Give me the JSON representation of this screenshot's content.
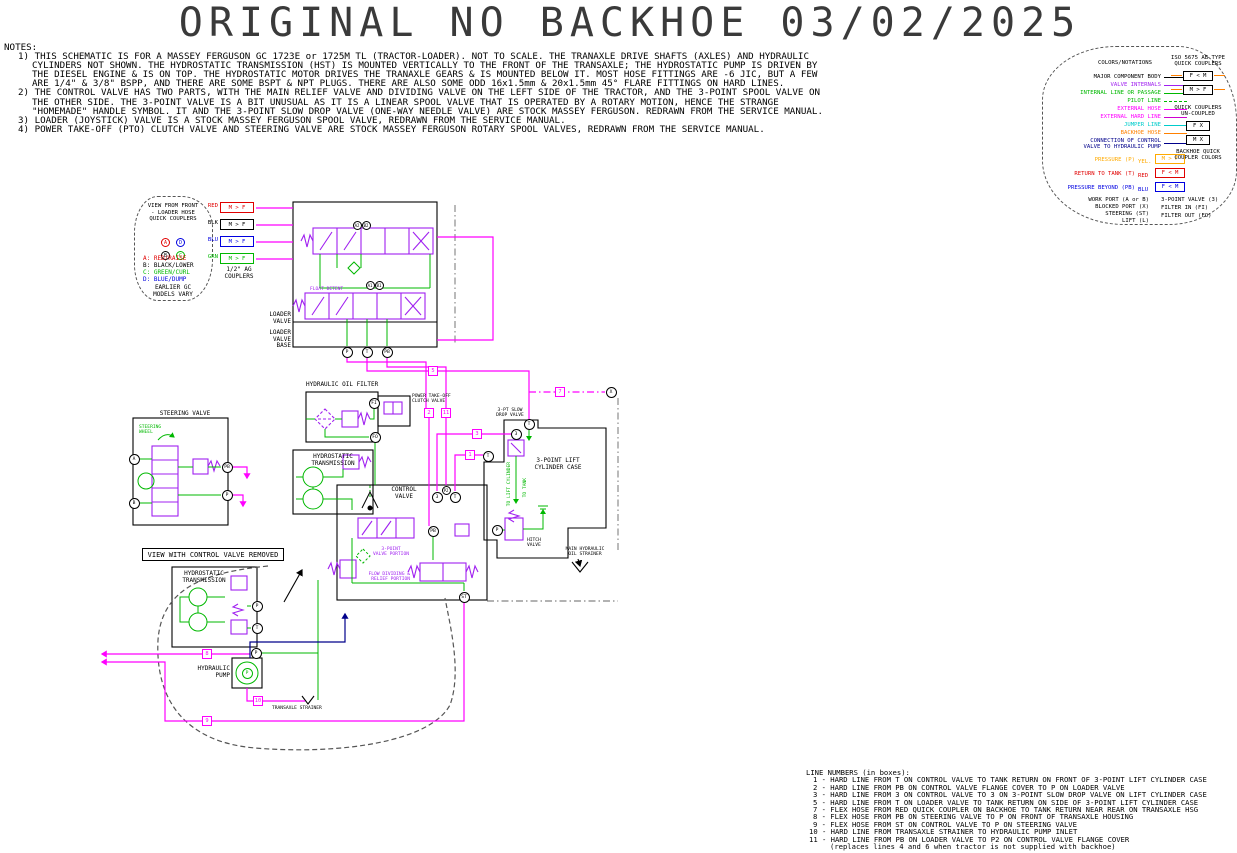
{
  "title": "ORIGINAL NO BACKHOE 03/02/2025",
  "notes": {
    "heading": "NOTES:",
    "items": [
      "1) THIS SCHEMATIC IS FOR A MASSEY FERGUSON GC 1723E or 1725M TL (TRACTOR-LOADER). NOT TO SCALE. THE TRANAXLE DRIVE SHAFTS (AXLES) AND HYDRAULIC\nCYLINDERS NOT SHOWN. THE HYDROSTATIC TRANSMISSION (HST) IS MOUNTED VERTICALLY TO THE FRONT OF THE TRANSAXLE; THE HYDROSTATIC PUMP IS DRIVEN BY\nTHE DIESEL ENGINE & IS ON TOP. THE HYDROSTATIC MOTOR DRIVES THE TRANAXLE GEARS & IS MOUNTED BELOW IT. MOST HOSE FITTINGS ARE -6 JIC, BUT A FEW\nARE 1/4\" & 3/8\" BSPP, AND THERE ARE SOME BSPT & NPT PLUGS. THERE ARE ALSO SOME ODD 16x1.5mm & 20x1.5mm 45° FLARE FITTINGS ON HARD LINES.",
      "2) THE CONTROL VALVE HAS TWO PARTS, WITH THE MAIN RELIEF VALVE AND DIVIDING VALVE ON THE LEFT SIDE OF THE TRACTOR, AND THE 3-POINT SPOOL VALVE ON\nTHE OTHER SIDE. THE 3-POINT VALVE IS A BIT UNUSUAL AS IT IS A LINEAR SPOOL VALVE THAT IS OPERATED BY A ROTARY MOTION, HENCE THE STRANGE\n\"HOMEMADE\" HANDLE SYMBOL. IT AND THE 3-POINT SLOW DROP VALVE (ONE-WAY NEEDLE VALVE) ARE STOCK MASSEY FERGUSON. REDRAWN FROM THE SERVICE MANUAL.",
      "3) LOADER (JOYSTICK) VALVE IS A STOCK MASSEY FERGUSON SPOOL VALVE, REDRAWN FROM THE SERVICE MANUAL.",
      "4) POWER TAKE-OFF (PTO) CLUTCH VALVE AND STEERING VALVE ARE STOCK MASSEY FERGUSON ROTARY SPOOL VALVES, REDRAWN FROM THE SERVICE MANUAL."
    ]
  },
  "legend": {
    "header": "COLORS/NOTATIONS",
    "rows": [
      {
        "label": "MAJOR COMPONENT BODY"
      },
      {
        "label": "VALVE INTERNALS"
      },
      {
        "label": "INTERNAL LINE OR PASSAGE"
      },
      {
        "label": "PILOT LINE"
      },
      {
        "label": "EXTERNAL HOSE"
      },
      {
        "label": "EXTERNAL HARD LINE"
      },
      {
        "label": "JUMPER LINE"
      },
      {
        "label": "BACKHOE HOSE"
      },
      {
        "label": "CONNECTION OF CONTROL\nVALVE TO HYDRAULIC PUMP"
      }
    ],
    "port_rows": [
      {
        "label": "PRESSURE (P)",
        "tag": "YEL.",
        "box": "M > F"
      },
      {
        "label": "RETURN TO TANK (T)",
        "tag": "RED",
        "box": "F < M"
      },
      {
        "label": "PRESSURE BEYOND (PB)",
        "tag": "BLU",
        "box": "F < M"
      }
    ],
    "abbrev": [
      "WORK PORT (A or B)",
      "BLOCKED PORT (X)",
      "STEERING (ST)",
      "LIFT (L)"
    ],
    "right": {
      "iso_header": "ISO 5675 AB TYPE\nQUICK COUPLERS",
      "iso_box1": "F < M",
      "iso_box2": "M > F",
      "unc_header": "QUICK COUPLERS\nUN-COUPLED",
      "unc_box1": "F X",
      "unc_box2": "M X",
      "backhoe_header": "BACKHOE QUICK\nCOUPLER COLORS",
      "abbrev2": [
        "3-POINT VALVE (3)",
        "FILTER IN (FI)",
        "FILTER OUT (FO)"
      ]
    },
    "colors": {
      "component": "#000000",
      "valve_internals": "#a020f0",
      "internal_line": "#00b800",
      "pilot_line": "#00b800",
      "external_hose": "#ff00ff",
      "external_hard_line": "#d000d0",
      "jumper_line": "#00cccc",
      "backhoe_hose": "#ff8000",
      "pump_connection": "#00008b",
      "pressure": "#ffaa00",
      "return_to_tank": "#e00000",
      "pressure_beyond": "#0000e0"
    }
  },
  "coupler_view": {
    "title": "VIEW FROM FRONT\n- LOADER HOSE\nQUICK COUPLERS",
    "c1": "A",
    "c2": "D",
    "c3": "B",
    "c4": "C",
    "list": [
      "A: RED/RAISE",
      "B: BLACK/LOWER",
      "C: GREEN/CURL",
      "D: BLUE/DUMP"
    ],
    "footer": "EARLIER GC\nMODELS VARY"
  },
  "couplers": {
    "tags": [
      "RED",
      "BLK",
      "BLU",
      "GRN"
    ],
    "box": "M > F",
    "caption": "1/2\" AG\nCOUPLERS"
  },
  "schematic": {
    "labels": {
      "loader_valve": "LOADER\nVALVE",
      "loader_valve_base": "LOADER\nVALVE\nBASE",
      "float_detent": "FLOAT DETENT",
      "hydraulic_oil_filter": "HYDRAULIC OIL FILTER",
      "pto_valve": "POWER TAKE-OFF\nCLUTCH VALVE",
      "hst": "HYDROSTATIC\nTRANSMISSION",
      "control_valve": "CONTROL\nVALVE",
      "three_point_portion": "3-POINT\nVALVE PORTION",
      "flow_div_portion": "FLOW DIVIDING &\nRELIEF PORTION",
      "steering_valve": "STEERING VALVE",
      "steering_wheel": "STEERING\nWHEEL",
      "cyl_case": "3-POINT LIFT\nCYLINDER CASE",
      "slow_drop": "3-PT SLOW\nDROP VALVE",
      "hitch_valve": "HITCH\nVALVE",
      "to_lift_cyl": "TO LIFT CYLINDER",
      "to_tank": "TO TANK",
      "main_strainer": "MAIN HYDRAULIC\nOIL STRAINER",
      "view_removed": "VIEW WITH CONTROL VALVE REMOVED",
      "hst2": "HYDROSTATIC\nTRANSMISSION",
      "hyd_pump": "HYDRAULIC\nPUMP",
      "transaxle_strainer": "TRANSAXLE STRAINER"
    },
    "ports": {
      "p": "P",
      "t": "T",
      "pb": "PB",
      "p2": "P2",
      "fi": "FI",
      "fo": "FO",
      "a": "A",
      "b": "B",
      "n3": "3",
      "st": "ST",
      "x": "X",
      "a1": "A1",
      "b1": "B1",
      "a2": "A2",
      "b2": "B2"
    },
    "markers": {
      "m1": "1",
      "m2": "2",
      "m3": "3",
      "m5": "5",
      "m7": "7",
      "m8": "8",
      "m9": "9",
      "m10": "10",
      "m11": "11"
    }
  },
  "line_numbers": {
    "heading": "LINE NUMBERS (in boxes):",
    "items": [
      "1 - HARD LINE FROM T ON CONTROL VALVE TO TANK RETURN ON FRONT OF 3-POINT LIFT CYLINDER CASE",
      "2 - HARD LINE FROM PB ON CONTROL VALVE FLANGE COVER TO P ON LOADER VALVE",
      "3 - HARD LINE FROM 3 ON CONTROL VALVE TO 3 ON 3-POINT SLOW DROP VALVE ON LIFT CYLINDER CASE",
      "5 - HARD LINE FROM T ON LOADER VALVE TO TANK RETURN ON SIDE OF 3-POINT LIFT CYLINDER CASE",
      "7 - FLEX HOSE FROM RED QUICK COUPLER ON BACKHOE TO TANK RETURN NEAR REAR ON TRANSAXLE HSG",
      "8 - FLEX HOSE FROM PB ON STEERING VALVE TO P ON FRONT OF TRANSAXLE HOUSING",
      "9 - FLEX HOSE FROM ST ON CONTROL VALVE TO P ON STEERING VALVE",
      "10 - HARD LINE FROM TRANSAXLE STRAINER TO HYDRAULIC PUMP INLET",
      "11 - HARD LINE FROM PB ON LOADER VALVE TO P2 ON CONTROL VALVE FLANGE COVER"
    ],
    "footnote": "(replaces lines 4 and 6 when tractor is not supplied with backhoe)"
  }
}
